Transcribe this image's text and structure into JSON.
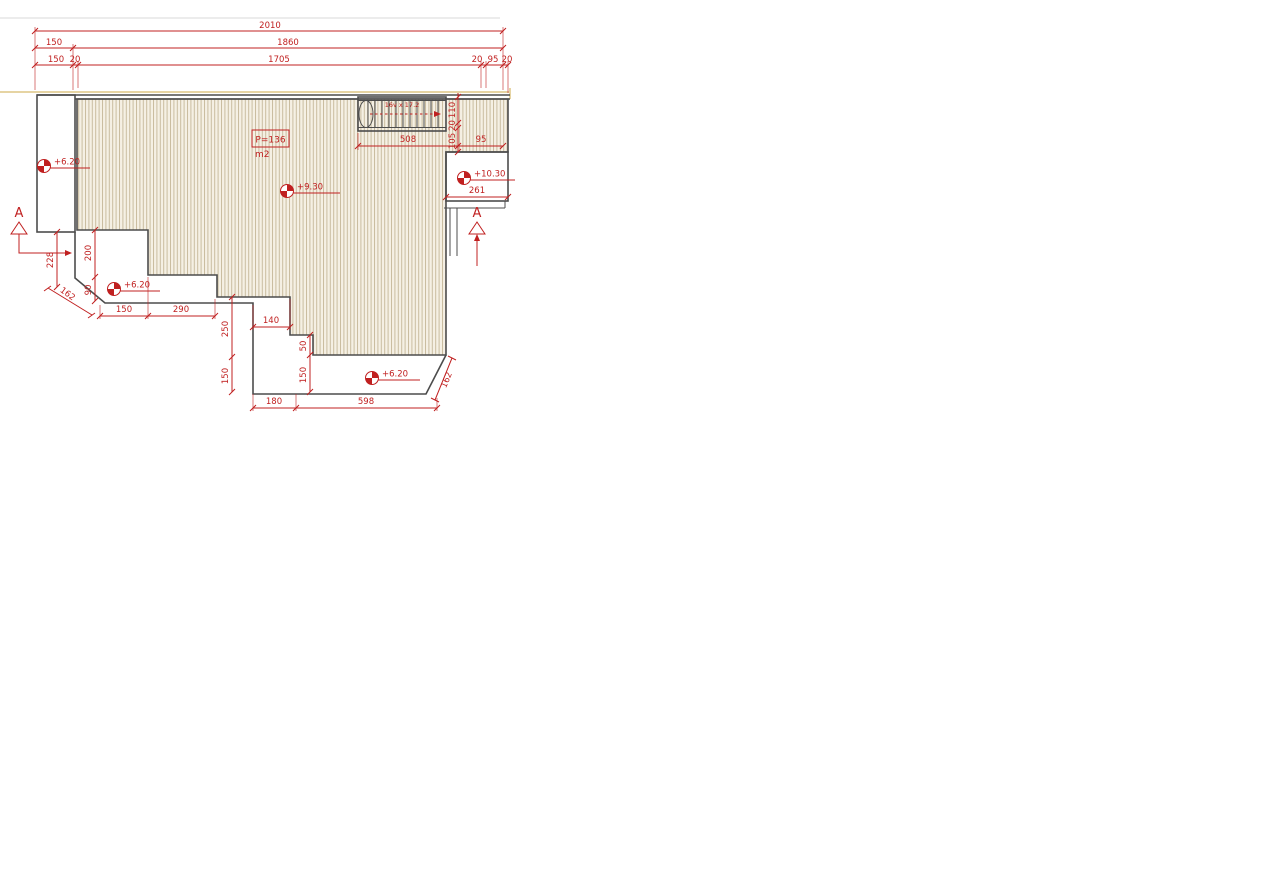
{
  "drawing": {
    "type": "architectural-roof-terrace-plan",
    "colors": {
      "dimension_red": "#c02020",
      "outline_dark": "#4c4c4c",
      "hatch_background": "#f5f0e4",
      "hatch_stripe": "#c9bc9f",
      "tan_line": "#e6d4a3"
    },
    "area_label": {
      "boxed_value": "P=136",
      "unit": "m2"
    },
    "stair": {
      "label": "16v x 17.2"
    },
    "sections": {
      "left": "A",
      "right": "A"
    },
    "levels": {
      "left_strip": "+6.20",
      "main_deck": "+9.30",
      "right_room": "+10.30",
      "terrace_left": "+6.20",
      "terrace_bottom": "+6.20"
    },
    "dims": {
      "total": "2010",
      "row2_left": "150",
      "row2_main": "1860",
      "row3_left": "150",
      "row3_g1": "20",
      "row3_main": "1705",
      "row3_g2": "20",
      "row3_porch": "95",
      "row3_g3": "20",
      "stair_width": "508",
      "stair_v_110": "110",
      "stair_v_20": "20",
      "stair_v_105": "105",
      "right_95": "95",
      "room_width": "261",
      "left_228": "228",
      "left_200": "200",
      "left_90": "90",
      "diag_left": "162",
      "bl_150": "150",
      "bl_290": "290",
      "mid_140": "140",
      "mid_250": "250",
      "mid_150": "150",
      "mid_50": "50",
      "low_150": "150",
      "bottom_180": "180",
      "bottom_598": "598",
      "diag_right": "162"
    }
  }
}
